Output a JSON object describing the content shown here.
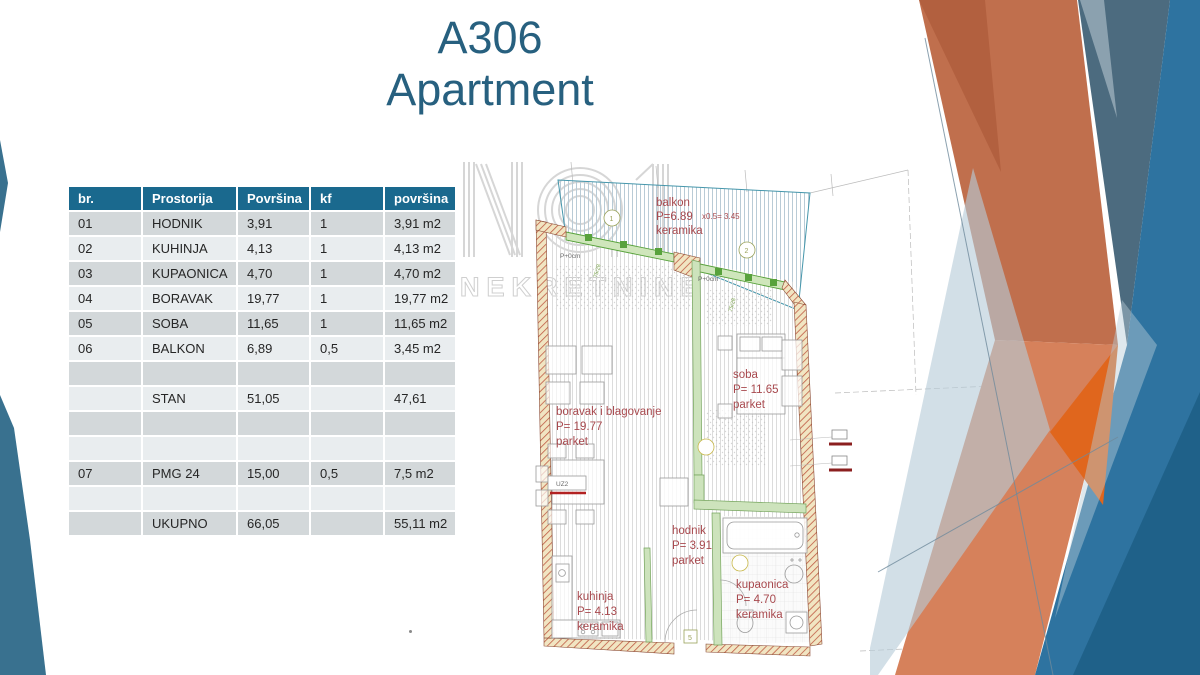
{
  "slide": {
    "title_line1": "A306",
    "title_line2": "Apartment"
  },
  "table": {
    "headers": [
      "br.",
      "Prostorija",
      "Površina",
      "kf",
      "površina"
    ],
    "rows": [
      [
        "01",
        "HODNIK",
        "3,91",
        "1",
        "3,91 m2"
      ],
      [
        "02",
        "KUHINJA",
        "4,13",
        "1",
        "4,13 m2"
      ],
      [
        "03",
        "KUPAONICA",
        "4,70",
        "1",
        "4,70 m2"
      ],
      [
        "04",
        "BORAVAK",
        "19,77",
        "1",
        "19,77 m2"
      ],
      [
        "05",
        "SOBA",
        "11,65",
        "1",
        "11,65 m2"
      ],
      [
        "06",
        "BALKON",
        "6,89",
        "0,5",
        "3,45 m2"
      ],
      [
        "",
        "",
        "",
        "",
        ""
      ],
      [
        "",
        "STAN",
        "51,05",
        "",
        "47,61"
      ],
      [
        "",
        "",
        "",
        "",
        ""
      ],
      [
        "",
        "",
        "",
        "",
        ""
      ],
      [
        "07",
        "PMG 24",
        "15,00",
        "0,5",
        "7,5 m2"
      ],
      [
        "",
        "",
        "",
        "",
        ""
      ],
      [
        "",
        "UKUPNO",
        "66,05",
        "",
        "55,11 m2"
      ]
    ]
  },
  "floorplan": {
    "watermark": {
      "logo": "NO.1",
      "name": "NEKRETNINE"
    },
    "labels": {
      "balkon": {
        "name": "balkon",
        "area": "P=6.89",
        "factor": "x0.5=  3.45",
        "floor": "keramika"
      },
      "soba": {
        "name": "soba",
        "area": "P= 11.65",
        "floor": "parket"
      },
      "boravak": {
        "name": "boravak i blagovanje",
        "area": "P= 19.77",
        "floor": "parket"
      },
      "hodnik": {
        "name": "hodnik",
        "area": "P= 3.91",
        "floor": "parket"
      },
      "kuhinja": {
        "name": "kuhinja",
        "area": "P= 4.13",
        "floor": "keramika"
      },
      "kupaonica": {
        "name": "kupaonica",
        "area": "P= 4.70",
        "floor": "keramika"
      }
    },
    "annotations": {
      "level_left": "P+0cm",
      "level_right": "P+0cm",
      "grid_marker_1": "1",
      "grid_marker_2": "2",
      "door_tag": "5",
      "furniture_tag": "UZ2",
      "dim_a": "75/28",
      "dim_b": "75/28"
    }
  },
  "colors": {
    "title_teal": "#27607F",
    "table_header": "#1A698E",
    "band_dark": "#D3D8DA",
    "band_light": "#E9EDEF",
    "plan_label_red": "#A8494E",
    "wall_hatch_red": "#C05B44",
    "wall_fill": "#F1E5C2",
    "railing_green": "#58A23C",
    "balcony_hatch_blue": "#B9CBD6",
    "deco_orange": "#C06F4D",
    "deco_salmon": "#D6815B",
    "deco_bright_orange": "#E0661D",
    "deco_slate": "#4C6B7F",
    "deco_blue": "#2E73A0",
    "deco_dark_blue": "#1E5E85",
    "deco_light_blue": "#B7CBD8",
    "left_wedge_blue": "#39718F"
  }
}
